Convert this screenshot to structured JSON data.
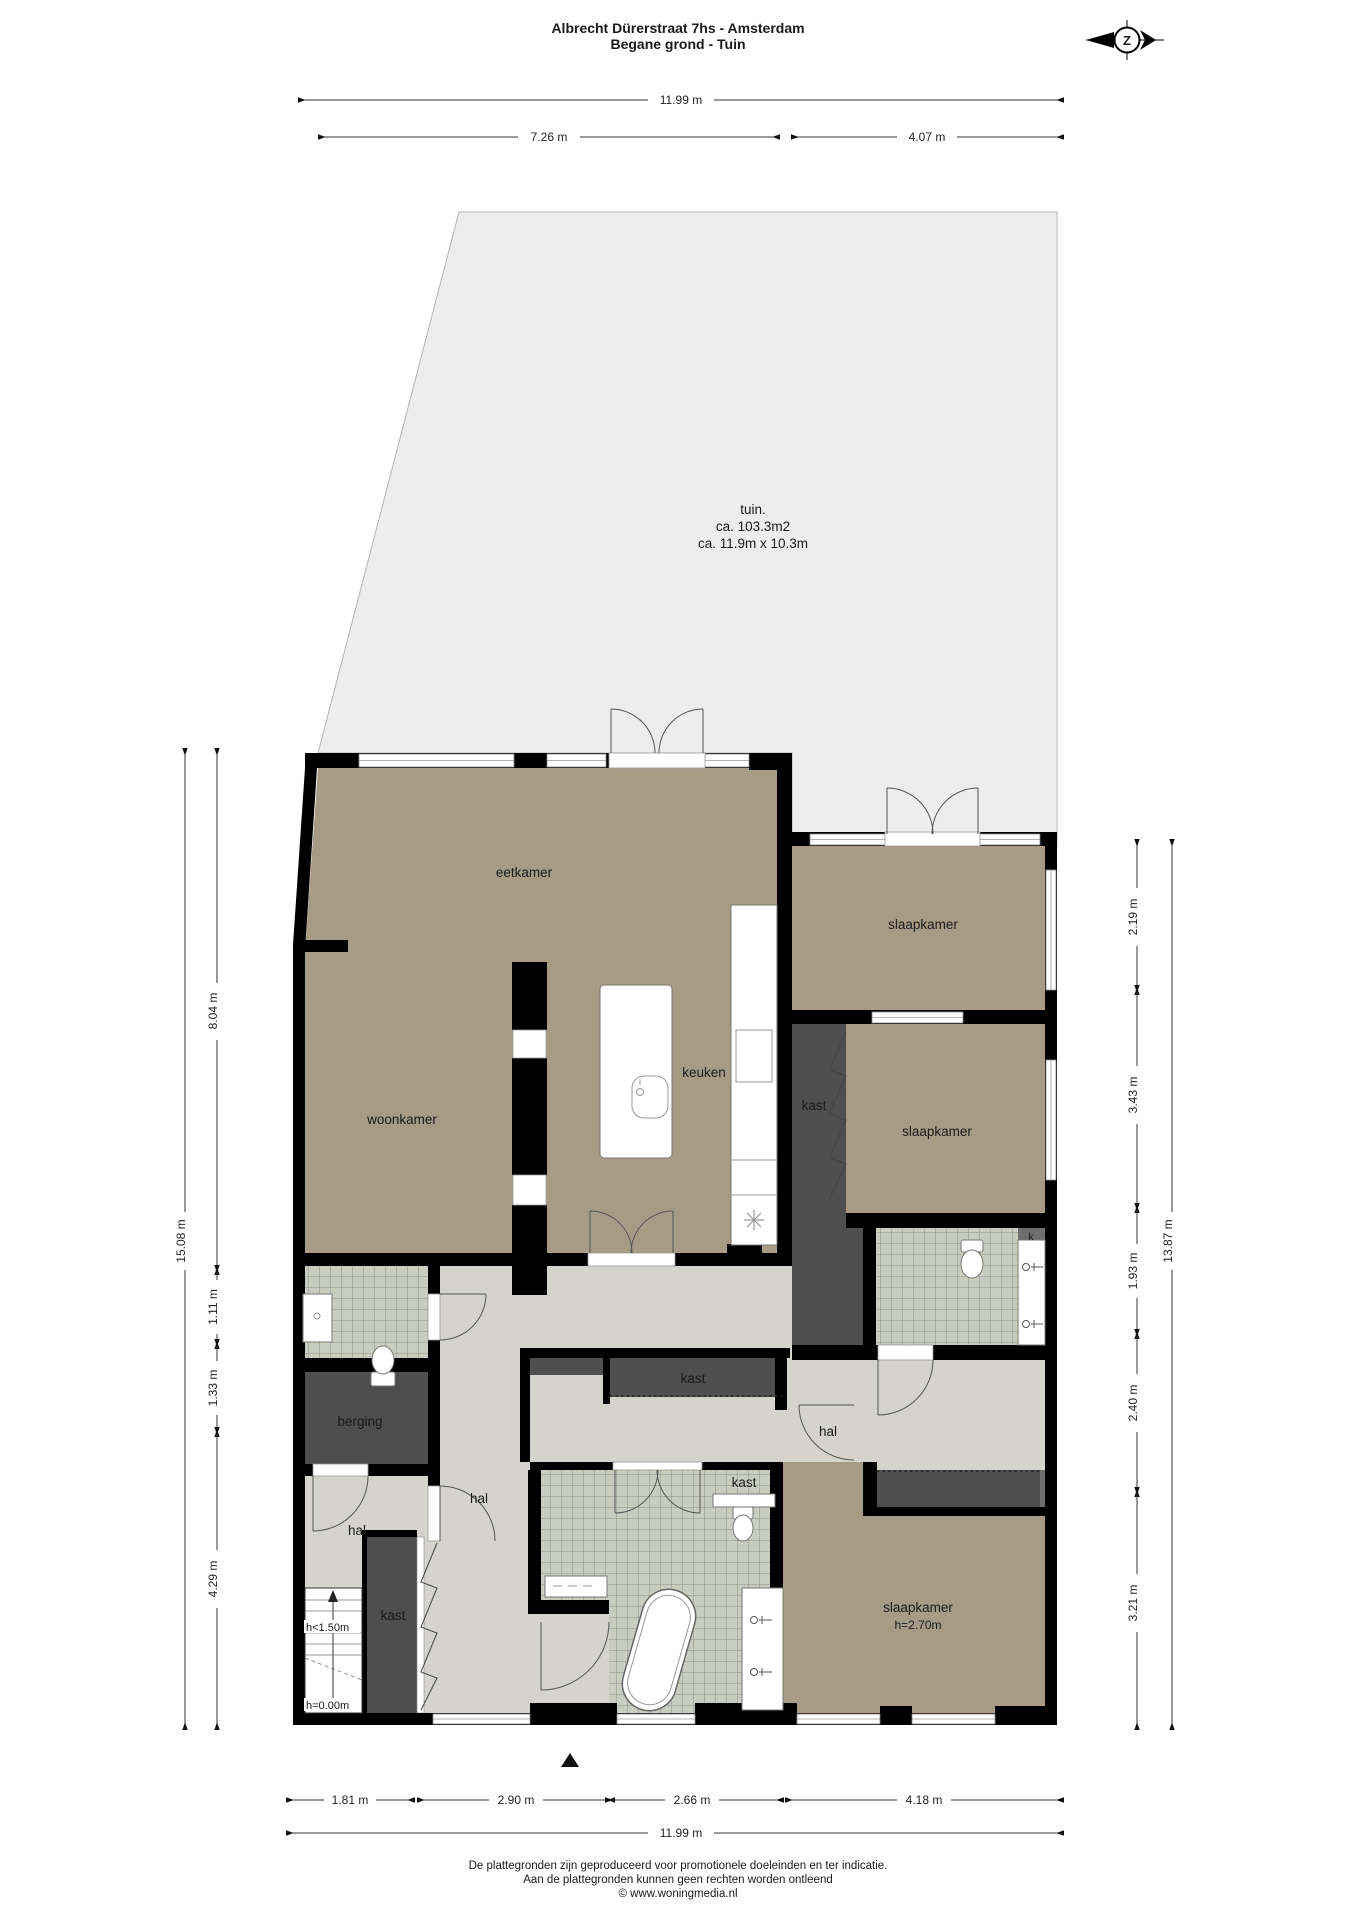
{
  "header": {
    "title": "Albrecht Dürerstraat 7hs - Amsterdam",
    "subtitle": "Begane grond - Tuin"
  },
  "compass": {
    "label": "Z"
  },
  "garden": {
    "name": "tuin.",
    "area": "ca. 103.3m2",
    "size": "ca. 11.9m x 10.3m"
  },
  "rooms": {
    "eetkamer": "eetkamer",
    "woonkamer": "woonkamer",
    "keuken": "keuken",
    "slaapkamer_1": "slaapkamer",
    "slaapkamer_2": "slaapkamer",
    "slaapkamer_3": "slaapkamer",
    "slaapkamer_3_height": "h=2.70m",
    "kast_keuken": "kast",
    "kast_hal_boven": "kast",
    "kast_hal_onder": "kast",
    "kast_trap": "kast",
    "kast_k": "k",
    "berging": "berging",
    "hal_links": "hal",
    "hal_klein": "hal",
    "hal_rechts": "hal"
  },
  "stairs": {
    "upper_label": "h<1.50m",
    "ground_label": "h=0.00m"
  },
  "dimensions": {
    "top": {
      "total": "11.99 m",
      "left": "7.26 m",
      "right": "4.07 m"
    },
    "left": {
      "total": "15.08 m",
      "segments": [
        "8.04 m",
        "1.11 m",
        "1.33 m",
        "4.29 m"
      ]
    },
    "right": {
      "total": "13.87 m",
      "segments": [
        "2.19 m",
        "3.43 m",
        "1.93 m",
        "2.40 m",
        "3.21 m"
      ]
    },
    "bottom": {
      "segments": [
        "1.81 m",
        "2.90 m",
        "2.66 m",
        "4.18 m"
      ],
      "total": "11.99 m"
    }
  },
  "footer": {
    "line1": "De plattegronden zijn geproduceerd voor promotionele doeleinden en ter indicatie.",
    "line2": "Aan de plattegronden kunnen geen rechten worden ontleend",
    "line3": "© www.woningmedia.nl"
  },
  "colors": {
    "wall": "#000000",
    "room_floor": "#a89b85",
    "hall_floor": "#d4d4cc",
    "tile_floor": "#c9cdc0",
    "closet": "#4e4e4e",
    "garden": "#ededed"
  }
}
